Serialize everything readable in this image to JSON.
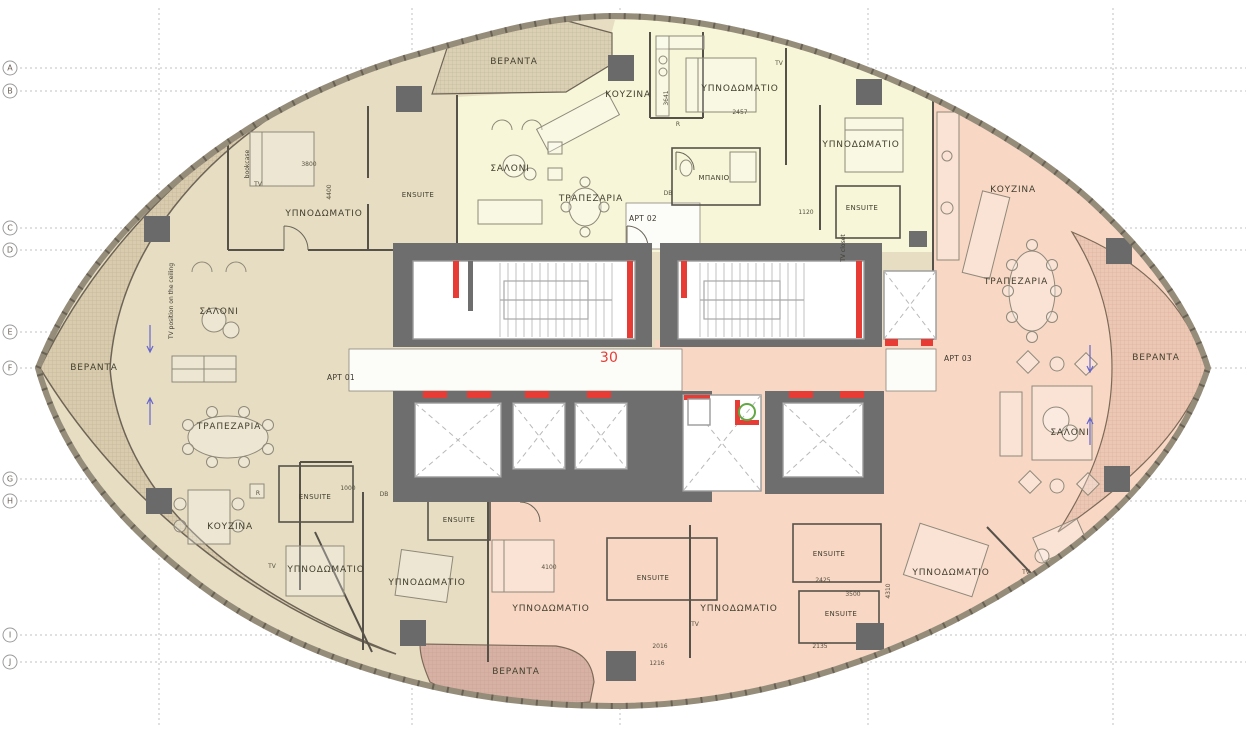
{
  "floor": {
    "label": "30"
  },
  "colors": {
    "apt1": "#e7ddc3",
    "apt2": "#f7f6d8",
    "apt3": "#f8d7c5",
    "veranda_beige": "#d9ccae",
    "veranda_top": "#dbd0b4",
    "veranda_pink": "#ecc7b3",
    "veranda_bottom": "#d7b2a4",
    "core": "#6e6e6e",
    "column": "#6a6a6a",
    "red": "#e63c35",
    "green": "#62a844",
    "corridor": "#fcfcf8"
  },
  "grid": {
    "rows": [
      {
        "label": "A",
        "y": 68
      },
      {
        "label": "B",
        "y": 91
      },
      {
        "label": "C",
        "y": 228
      },
      {
        "label": "D",
        "y": 250
      },
      {
        "label": "E",
        "y": 332
      },
      {
        "label": "F",
        "y": 368
      },
      {
        "label": "G",
        "y": 479
      },
      {
        "label": "H",
        "y": 501
      },
      {
        "label": "I",
        "y": 635
      },
      {
        "label": "J",
        "y": 662
      }
    ],
    "cols": [
      {
        "x": 159
      },
      {
        "x": 412
      },
      {
        "x": 620
      },
      {
        "x": 868
      },
      {
        "x": 1113
      }
    ]
  },
  "apartments": [
    {
      "name": "APT 01",
      "x": 341,
      "y": 380
    },
    {
      "name": "APT 02",
      "x": 643,
      "y": 221
    },
    {
      "name": "APT 03",
      "x": 958,
      "y": 361
    }
  ],
  "rooms": [
    {
      "name": "ΒΕΡΑΝΤΑ",
      "x": 94,
      "y": 370,
      "cls": "room"
    },
    {
      "name": "ΥΠΝΟΔΩΜΑΤΙΟ",
      "x": 324,
      "y": 216,
      "cls": "room"
    },
    {
      "name": "ENSUITE",
      "x": 418,
      "y": 197,
      "cls": "small"
    },
    {
      "name": "ΣΑΛΟΝΙ",
      "x": 219,
      "y": 314,
      "cls": "room"
    },
    {
      "name": "ΤΡΑΠΕΖΑΡΙΑ",
      "x": 229,
      "y": 429,
      "cls": "room"
    },
    {
      "name": "ΚΟΥΖΙΝΑ",
      "x": 230,
      "y": 529,
      "cls": "room"
    },
    {
      "name": "ENSUITE",
      "x": 315,
      "y": 499,
      "cls": "small"
    },
    {
      "name": "ENSUITE",
      "x": 459,
      "y": 522,
      "cls": "small"
    },
    {
      "name": "ΥΠΝΟΔΩΜΑΤΙΟ",
      "x": 326,
      "y": 572,
      "cls": "room"
    },
    {
      "name": "ΥΠΝΟΔΩΜΑΤΙΟ",
      "x": 427,
      "y": 585,
      "cls": "room"
    },
    {
      "name": "ΒΕΡΑΝΤΑ",
      "x": 514,
      "y": 64,
      "cls": "room"
    },
    {
      "name": "ΚΟΥΖΙΝΑ",
      "x": 628,
      "y": 97,
      "cls": "room"
    },
    {
      "name": "ΥΠΝΟΔΩΜΑΤΙΟ",
      "x": 740,
      "y": 91,
      "cls": "room"
    },
    {
      "name": "ΥΠΝΟΔΩΜΑΤΙΟ",
      "x": 861,
      "y": 147,
      "cls": "room"
    },
    {
      "name": "ΜΠΑΝΙΟ",
      "x": 714,
      "y": 180,
      "cls": "small"
    },
    {
      "name": "ENSUITE",
      "x": 862,
      "y": 210,
      "cls": "small"
    },
    {
      "name": "ΣΑΛΟΝΙ",
      "x": 510,
      "y": 171,
      "cls": "room"
    },
    {
      "name": "ΤΡΑΠΕΖΑΡΙΑ",
      "x": 591,
      "y": 201,
      "cls": "room"
    },
    {
      "name": "ΚΟΥΖΙΝΑ",
      "x": 1013,
      "y": 192,
      "cls": "room"
    },
    {
      "name": "ΤΡΑΠΕΖΑΡΙΑ",
      "x": 1016,
      "y": 284,
      "cls": "room"
    },
    {
      "name": "ΒΕΡΑΝΤΑ",
      "x": 1156,
      "y": 360,
      "cls": "room"
    },
    {
      "name": "ΣΑΛΟΝΙ",
      "x": 1070,
      "y": 435,
      "cls": "room"
    },
    {
      "name": "ΥΠΝΟΔΩΜΑΤΙΟ",
      "x": 551,
      "y": 611,
      "cls": "room"
    },
    {
      "name": "ENSUITE",
      "x": 653,
      "y": 580,
      "cls": "small"
    },
    {
      "name": "ΥΠΝΟΔΩΜΑΤΙΟ",
      "x": 739,
      "y": 611,
      "cls": "room"
    },
    {
      "name": "ENSUITE",
      "x": 829,
      "y": 556,
      "cls": "small"
    },
    {
      "name": "ENSUITE",
      "x": 841,
      "y": 616,
      "cls": "small"
    },
    {
      "name": "ΥΠΝΟΔΩΜΑΤΙΟ",
      "x": 951,
      "y": 575,
      "cls": "room"
    },
    {
      "name": "ΒΕΡΑΝΤΑ",
      "x": 516,
      "y": 674,
      "cls": "room"
    }
  ],
  "notes": [
    {
      "text": "TV position on the ceiling",
      "x": 173,
      "y": 301,
      "rot": -90
    },
    {
      "text": "TV closet",
      "x": 845,
      "y": 248,
      "rot": -90
    },
    {
      "text": "bookcase",
      "x": 249,
      "y": 164,
      "rot": -90
    }
  ],
  "tv_label": "TV",
  "tv_positions": [
    {
      "x": 258,
      "y": 186
    },
    {
      "x": 272,
      "y": 568
    },
    {
      "x": 695,
      "y": 626
    },
    {
      "x": 779,
      "y": 65
    },
    {
      "x": 1026,
      "y": 574
    }
  ],
  "annotations": [
    {
      "text": "3800",
      "x": 309,
      "y": 166
    },
    {
      "text": "4400",
      "x": 331,
      "y": 192,
      "rot": -90
    },
    {
      "text": "2457",
      "x": 740,
      "y": 114
    },
    {
      "text": "3641",
      "x": 668,
      "y": 98,
      "rot": -90
    },
    {
      "text": "1120",
      "x": 806,
      "y": 214
    },
    {
      "text": "4100",
      "x": 549,
      "y": 569
    },
    {
      "text": "2016",
      "x": 660,
      "y": 648
    },
    {
      "text": "1216",
      "x": 657,
      "y": 665
    },
    {
      "text": "2425",
      "x": 823,
      "y": 582
    },
    {
      "text": "4310",
      "x": 890,
      "y": 591,
      "rot": -90
    },
    {
      "text": "3500",
      "x": 853,
      "y": 596
    },
    {
      "text": "1000",
      "x": 348,
      "y": 490
    },
    {
      "text": "2135",
      "x": 820,
      "y": 648
    },
    {
      "text": "R",
      "x": 258,
      "y": 495
    },
    {
      "text": "R",
      "x": 678,
      "y": 126
    },
    {
      "text": "DB",
      "x": 668,
      "y": 195
    },
    {
      "text": "DB",
      "x": 384,
      "y": 496
    }
  ]
}
